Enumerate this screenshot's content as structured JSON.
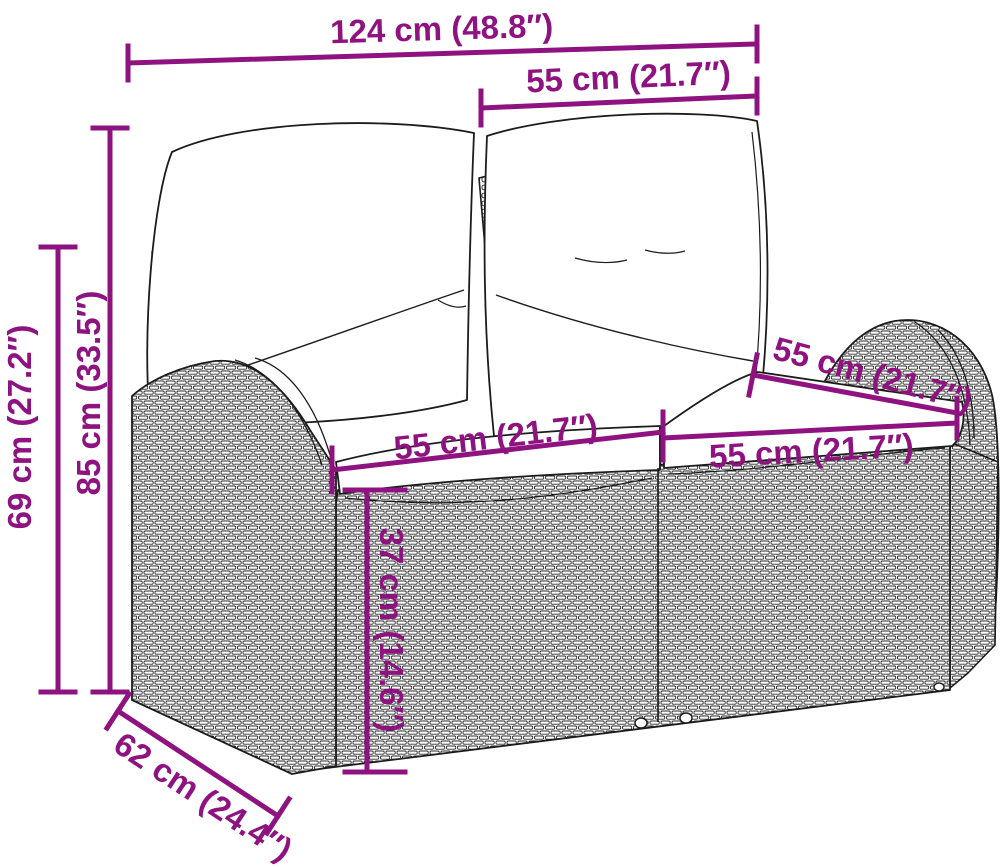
{
  "diagram": {
    "kind": "product-dimension-diagram",
    "subject": "poly rattan 2-seater garden sofa with back and seat cushions",
    "dimensions": [
      {
        "id": "overall_width",
        "label": "124 cm (48.8″)"
      },
      {
        "id": "backrest_cushion_width",
        "label": "55 cm (21.7″)"
      },
      {
        "id": "overall_height",
        "label": "85 cm (33.5″)"
      },
      {
        "id": "backrest_height",
        "label": "69 cm (27.2″)"
      },
      {
        "id": "seat_width_left",
        "label": "55 cm (21.7″)"
      },
      {
        "id": "seat_width_right",
        "label": "55 cm (21.7″)"
      },
      {
        "id": "seat_depth",
        "label": "55 cm (21.7″)"
      },
      {
        "id": "seat_height",
        "label": "37 cm (14.6″)"
      },
      {
        "id": "overall_depth",
        "label": "62 cm (24.4″)"
      }
    ],
    "colors": {
      "dimension_magenta": "#8E1380",
      "line_art_black": "#1c1c1c",
      "background": "#ffffff"
    }
  }
}
